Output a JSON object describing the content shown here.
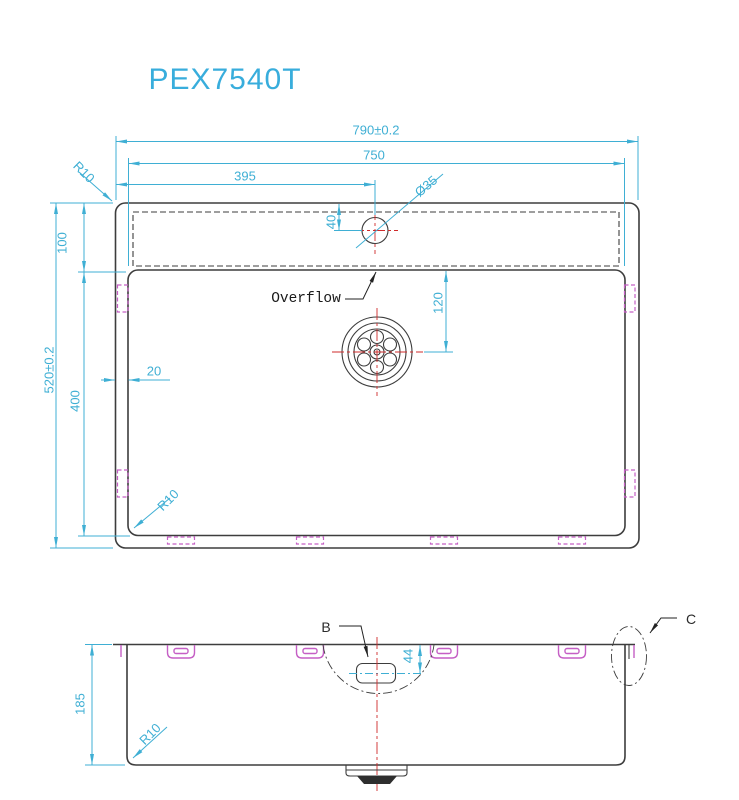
{
  "title": "PEX7540T",
  "colors": {
    "accent_cyan": "#3fafd4",
    "outline": "#3d3d3d",
    "clip_magenta": "#c55fc5",
    "centerline_red": "#cf2b2b",
    "title_blue": "#38addc"
  },
  "top_view": {
    "dim_overall_width": "790±0.2",
    "dim_bowl_width": "750",
    "dim_faucet_offset": "395",
    "dim_faucet_hole": "Ø35",
    "dim_corner_radius_rim": "R10",
    "dim_deck_depth": "100",
    "dim_overall_depth": "520±0.2",
    "dim_bowl_depth": "400",
    "dim_rim_gap": "20",
    "dim_faucet_setback": "40",
    "dim_drain_offset": "120",
    "dim_corner_radius_bowl": "R10",
    "overflow_label": "Overflow"
  },
  "front_view": {
    "dim_height": "185",
    "dim_overflow_depth": "44",
    "dim_corner_radius": "R10",
    "detail_b_label": "B",
    "detail_c_label": "C"
  }
}
